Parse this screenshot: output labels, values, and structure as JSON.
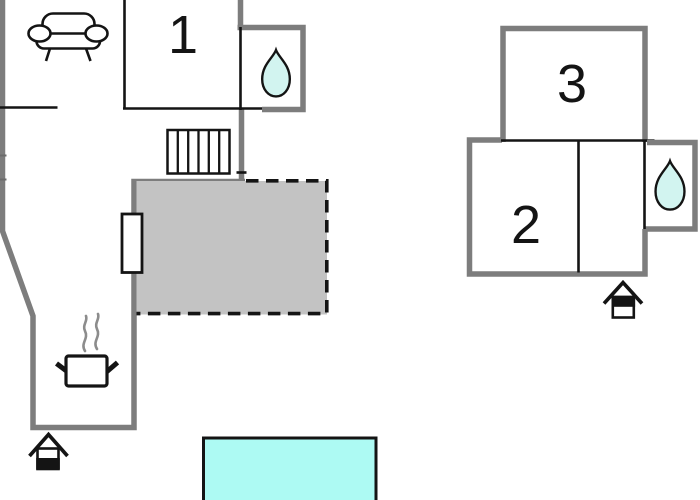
{
  "floorplan": {
    "room_labels": {
      "room1": "1",
      "room2": "2",
      "room3": "3"
    },
    "colors": {
      "wall": "#7d7d7d",
      "interior_line": "#141414",
      "terrace_fill": "#c3c3c3",
      "pool_fill": "#adfaf3",
      "droplet_fill": "#d2f4f0",
      "steam": "#8c8c8c",
      "background": "#ffffff"
    },
    "icons": [
      "sofa-icon",
      "water-drop-icon",
      "stairs-icon",
      "terrace-door",
      "cooking-pot-icon",
      "steam-icon",
      "entrance-icon",
      "pool"
    ]
  }
}
